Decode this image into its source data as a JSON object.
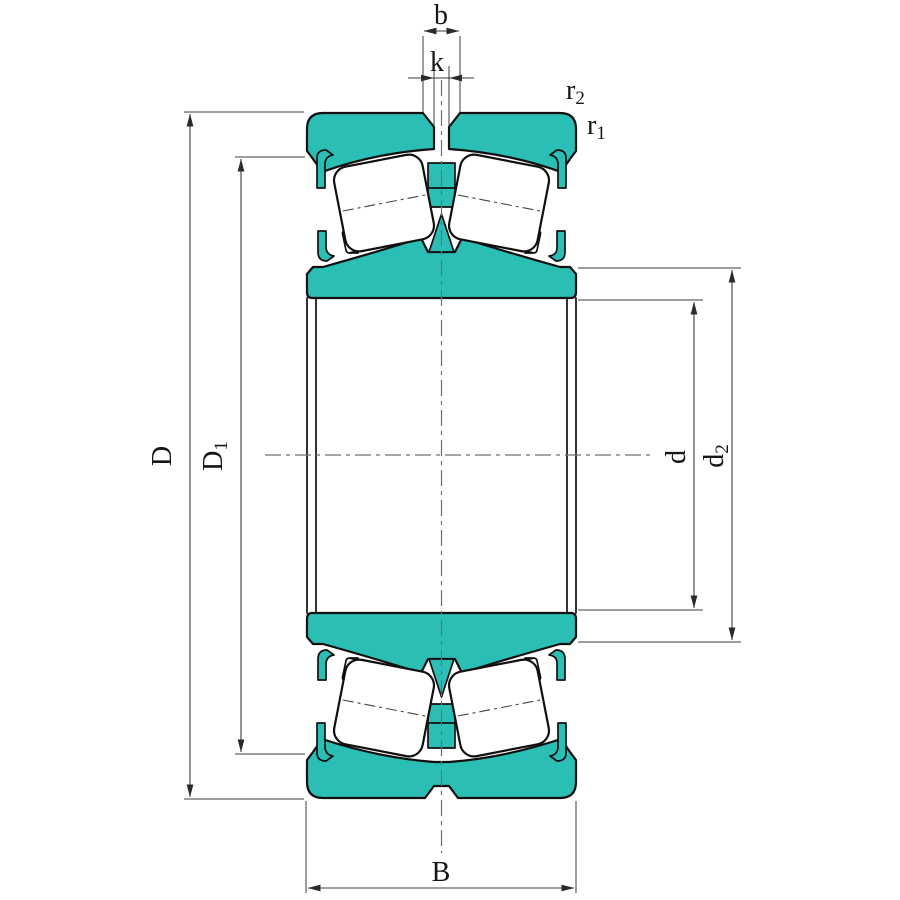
{
  "drawing": {
    "kind": "spherical roller bearing cross-section",
    "colors": {
      "ring_fill": "#2bbeb5",
      "outline": "#101010",
      "dimension_lines": "#3c3c3c",
      "centerlines": "#6f6f6f",
      "background": "#ffffff"
    },
    "labels": {
      "groove_width": {
        "base": "b",
        "sub": ""
      },
      "hole_width": {
        "base": "k",
        "sub": ""
      },
      "side_chamfer": {
        "base": "r",
        "sub": "2"
      },
      "outer_chamfer": {
        "base": "r",
        "sub": "1"
      },
      "outer_diameter": {
        "base": "D",
        "sub": ""
      },
      "shoulder_diameter": {
        "base": "D",
        "sub": "1"
      },
      "bore_diameter": {
        "base": "d",
        "sub": ""
      },
      "recess_diameter": {
        "base": "d",
        "sub": "2"
      },
      "width": {
        "base": "B",
        "sub": ""
      }
    }
  }
}
